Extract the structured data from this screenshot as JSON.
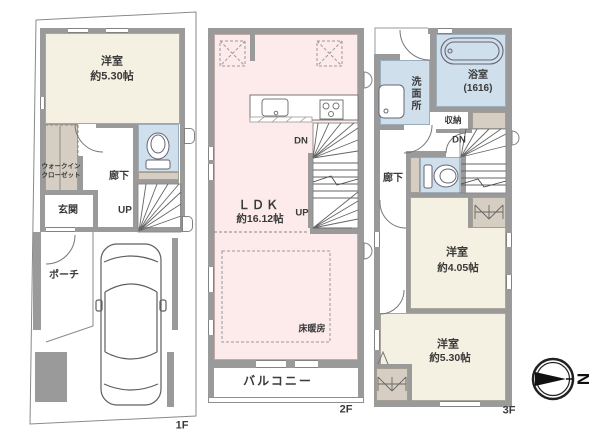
{
  "floor1": {
    "label": "1F",
    "room": "洋室",
    "room_size": "約5.30帖",
    "wic_line1": "ウォークイン",
    "wic_line2": "クローゼット",
    "entrance": "玄関",
    "hallway": "廊下",
    "stairs_up": "UP",
    "porch": "ポーチ"
  },
  "floor2": {
    "label": "2F",
    "ldk": "ＬＤＫ",
    "ldk_size": "約16.12帖",
    "stairs_down": "DN",
    "stairs_up": "UP",
    "floor_heating": "床暖房",
    "balcony": "バルコニー"
  },
  "floor3": {
    "label": "3F",
    "washroom": "洗面所",
    "bathroom": "浴室",
    "bathroom_size": "(1616)",
    "storage": "収納",
    "stairs_down": "DN",
    "hallway": "廊下",
    "room_a": "洋室",
    "room_a_size": "約4.05帖",
    "room_b": "洋室",
    "room_b_size": "約5.30帖"
  },
  "compass": {
    "north": "N"
  },
  "colors": {
    "wall": "#9a9a9a",
    "room_cream": "#f5f1e2",
    "room_pink": "#fcebea",
    "room_blue": "#cfdfeb",
    "closet_tan": "#d6cec2",
    "line": "#666666"
  }
}
